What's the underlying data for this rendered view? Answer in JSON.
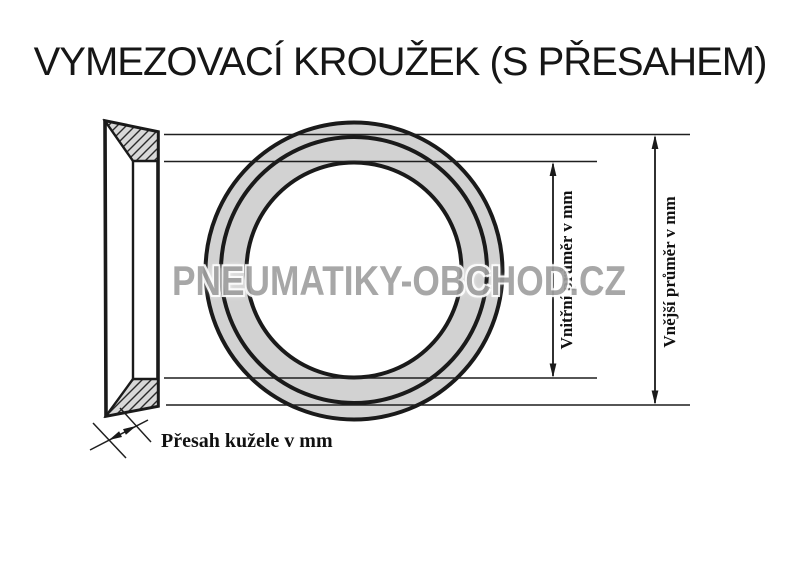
{
  "title": "VYMEZOVACÍ KROUŽEK (S PŘESAHEM)",
  "watermark": "PNEUMATIKY-OBCHOD.CZ",
  "drawing": {
    "labels": {
      "inner_diameter": "Vnitřní průměr v mm",
      "outer_diameter": "Vnější průměr v mm",
      "cone_overlap": "Přesah kužele v mm"
    },
    "views": [
      "ring-cross-section",
      "ring-front-view"
    ]
  },
  "icons": {
    "dimension_arrowhead": "filled-triangle"
  },
  "colors": {
    "background": "#ffffff",
    "line": "#1a1a1a",
    "ring_fill": "#d2d2d2",
    "hatch_fill": "#d8d8d8",
    "watermark_gray": "#a0a0a0"
  }
}
